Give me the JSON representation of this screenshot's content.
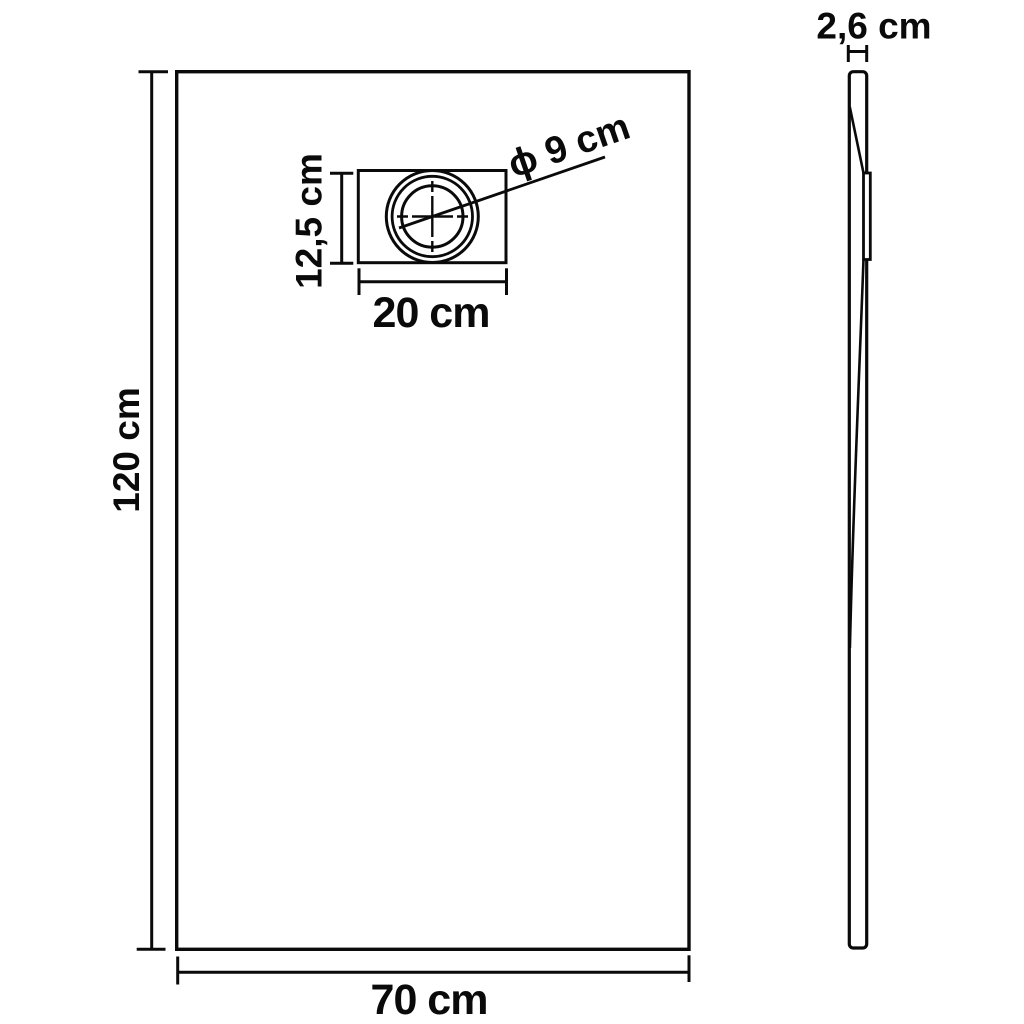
{
  "diagram": {
    "type": "technical-dimension-drawing",
    "subject": "rectangular shower base tray with drain, front view and side profile view",
    "background_color": "#ffffff",
    "line_color": "#0a0a0a",
    "unit": "cm",
    "labels": {
      "front_height": "120 cm",
      "front_width": "70 cm",
      "drain_box_width": "20 cm",
      "drain_box_height": "12,5 cm",
      "drain_diameter": "ϕ 9 cm",
      "side_thickness": "2,6 cm"
    },
    "values": {
      "front_height_cm": 120,
      "front_width_cm": 70,
      "drain_box_width_cm": 20,
      "drain_box_height_cm": 12.5,
      "drain_diameter_cm": 9,
      "side_thickness_cm": 2.6
    }
  }
}
